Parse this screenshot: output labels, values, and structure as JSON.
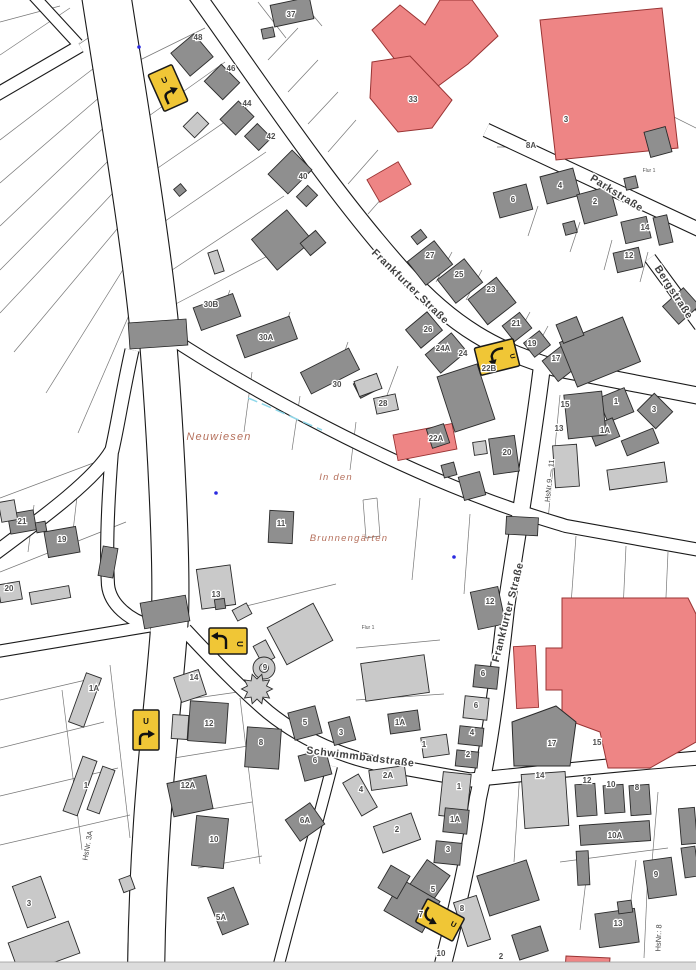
{
  "map": {
    "colors": {
      "background": "#ffffff",
      "building_dark": "#8f8f8f",
      "building_light": "#c9c9c9",
      "building_public": "#ee8585",
      "building_outline": "#2b2b2b",
      "public_outline": "#993333",
      "road_casing": "#1a1a1a",
      "road_fill": "#ffffff",
      "crossing_fill": "#8f8f8f",
      "parcel_line": "#777777",
      "sign_fill": "#f0c636",
      "sign_border": "#1a1a1a",
      "street_text": "#3f3f3f",
      "area_text": "#b5705c",
      "number_text": "#4d4d4d",
      "water": "#8fd8ea",
      "dot": "#2a2ae0",
      "edge_strip": "#dcdcdc"
    },
    "street_labels": [
      {
        "text": "Frankfurter Straße",
        "x": 408,
        "y": 289,
        "rot": 44,
        "size": 10.5
      },
      {
        "text": "Frankfurter Straße",
        "x": 511,
        "y": 613,
        "rot": -76,
        "size": 10.5
      },
      {
        "text": "Parkstraße",
        "x": 615,
        "y": 196,
        "rot": 32,
        "size": 10.5
      },
      {
        "text": "Bergstraße",
        "x": 671,
        "y": 294,
        "rot": 57,
        "size": 10.5
      },
      {
        "text": "Schwimmbadstraße",
        "x": 360,
        "y": 760,
        "rot": 7,
        "size": 10.5
      }
    ],
    "area_labels": [
      {
        "text": "Neuwiesen",
        "x": 219,
        "y": 440,
        "rot": 0,
        "size": 11
      },
      {
        "text": "In den",
        "x": 336,
        "y": 480,
        "rot": 0,
        "size": 9.5
      },
      {
        "text": "Brunnengärten",
        "x": 349,
        "y": 541,
        "rot": 0,
        "size": 9.5
      }
    ],
    "hsnr_labels": [
      {
        "text": "HsNr 9 — 11",
        "x": 552,
        "y": 481,
        "rot": -84,
        "size": 7.5
      },
      {
        "text": "HsNr. 3A",
        "x": 90,
        "y": 846,
        "rot": -80,
        "size": 7.5
      },
      {
        "text": "HsNr.: 8",
        "x": 661,
        "y": 938,
        "rot": -88,
        "size": 7.5
      }
    ],
    "flur_labels": [
      {
        "text": "Flur 1",
        "x": 649,
        "y": 172,
        "size": 5
      },
      {
        "text": "Flur 1",
        "x": 368,
        "y": 629,
        "size": 5
      }
    ],
    "house_numbers": [
      {
        "t": "48",
        "x": 198,
        "y": 40,
        "r": -35
      },
      {
        "t": "37",
        "x": 291,
        "y": 17,
        "r": -12
      },
      {
        "t": "46",
        "x": 231,
        "y": 71,
        "r": -48
      },
      {
        "t": "44",
        "x": 247,
        "y": 106,
        "r": -52
      },
      {
        "t": "42",
        "x": 271,
        "y": 139,
        "r": -52
      },
      {
        "t": "40",
        "x": 303,
        "y": 179,
        "r": -52
      },
      {
        "t": "33",
        "x": 413,
        "y": 102,
        "r": -58
      },
      {
        "t": "3",
        "x": 566,
        "y": 122,
        "r": -72
      },
      {
        "t": "8A",
        "x": 531,
        "y": 148,
        "r": 0
      },
      {
        "t": "6",
        "x": 513,
        "y": 202,
        "r": -14
      },
      {
        "t": "4",
        "x": 560,
        "y": 188,
        "r": -14
      },
      {
        "t": "2",
        "x": 595,
        "y": 204,
        "r": -14
      },
      {
        "t": "14",
        "x": 645,
        "y": 230,
        "r": -84
      },
      {
        "t": "12",
        "x": 629,
        "y": 258,
        "r": -84
      },
      {
        "t": "27",
        "x": 430,
        "y": 258,
        "r": -36
      },
      {
        "t": "25",
        "x": 459,
        "y": 277,
        "r": -36
      },
      {
        "t": "23",
        "x": 491,
        "y": 292,
        "r": -36
      },
      {
        "t": "21",
        "x": 516,
        "y": 326,
        "r": -8
      },
      {
        "t": "19",
        "x": 532,
        "y": 346,
        "r": -8
      },
      {
        "t": "17",
        "x": 556,
        "y": 361,
        "r": -8
      },
      {
        "t": "26",
        "x": 428,
        "y": 332,
        "r": -40
      },
      {
        "t": "24A",
        "x": 443,
        "y": 351,
        "r": -40
      },
      {
        "t": "24",
        "x": 463,
        "y": 356,
        "r": -40
      },
      {
        "t": "22B",
        "x": 489,
        "y": 371,
        "r": -34
      },
      {
        "t": "30B",
        "x": 211,
        "y": 307,
        "r": -20
      },
      {
        "t": "30A",
        "x": 266,
        "y": 340,
        "r": -20
      },
      {
        "t": "30",
        "x": 337,
        "y": 387,
        "r": -26
      },
      {
        "t": "28",
        "x": 383,
        "y": 406,
        "r": -10
      },
      {
        "t": "22A",
        "x": 436,
        "y": 441,
        "r": -10
      },
      {
        "t": "20",
        "x": 507,
        "y": 455,
        "r": -84
      },
      {
        "t": "15",
        "x": 565,
        "y": 407,
        "r": -84
      },
      {
        "t": "13",
        "x": 559,
        "y": 431,
        "r": -84
      },
      {
        "t": "1",
        "x": 616,
        "y": 404,
        "r": -38
      },
      {
        "t": "1A",
        "x": 605,
        "y": 433,
        "r": -22
      },
      {
        "t": "3",
        "x": 654,
        "y": 412,
        "r": -42
      },
      {
        "t": "21",
        "x": 22,
        "y": 524,
        "r": -6
      },
      {
        "t": "19",
        "x": 62,
        "y": 542,
        "r": -6
      },
      {
        "t": "20",
        "x": 9,
        "y": 591,
        "r": -6
      },
      {
        "t": "11",
        "x": 281,
        "y": 526,
        "r": 0
      },
      {
        "t": "13",
        "x": 216,
        "y": 597,
        "r": 0
      },
      {
        "t": "1A",
        "x": 94,
        "y": 691,
        "r": -75
      },
      {
        "t": "1",
        "x": 86,
        "y": 788,
        "r": -75
      },
      {
        "t": "14",
        "x": 194,
        "y": 680,
        "r": -14
      },
      {
        "t": "12",
        "x": 209,
        "y": 726,
        "r": -8
      },
      {
        "t": "9",
        "x": 265,
        "y": 670,
        "r": -30
      },
      {
        "t": "8",
        "x": 261,
        "y": 745,
        "r": -12
      },
      {
        "t": "5",
        "x": 305,
        "y": 725,
        "r": -12
      },
      {
        "t": "3",
        "x": 341,
        "y": 735,
        "r": -12
      },
      {
        "t": "6",
        "x": 315,
        "y": 763,
        "r": -12
      },
      {
        "t": "12A",
        "x": 188,
        "y": 788,
        "r": -10
      },
      {
        "t": "10",
        "x": 214,
        "y": 842,
        "r": -6
      },
      {
        "t": "6A",
        "x": 305,
        "y": 823,
        "r": -12
      },
      {
        "t": "5A",
        "x": 221,
        "y": 920,
        "r": -32
      },
      {
        "t": "3",
        "x": 29,
        "y": 906,
        "r": -78
      },
      {
        "t": "12",
        "x": 490,
        "y": 604,
        "r": -84
      },
      {
        "t": "6",
        "x": 483,
        "y": 676,
        "r": -84
      },
      {
        "t": "6",
        "x": 476,
        "y": 708,
        "r": -84
      },
      {
        "t": "4",
        "x": 472,
        "y": 735,
        "r": -84
      },
      {
        "t": "2",
        "x": 468,
        "y": 757,
        "r": -84
      },
      {
        "t": "1A",
        "x": 400,
        "y": 725,
        "r": 0
      },
      {
        "t": "1",
        "x": 424,
        "y": 747,
        "r": -12
      },
      {
        "t": "1",
        "x": 459,
        "y": 789,
        "r": -78
      },
      {
        "t": "1A",
        "x": 455,
        "y": 822,
        "r": -78
      },
      {
        "t": "3",
        "x": 448,
        "y": 852,
        "r": -78
      },
      {
        "t": "2",
        "x": 397,
        "y": 832,
        "r": -30
      },
      {
        "t": "4",
        "x": 361,
        "y": 792,
        "r": -55
      },
      {
        "t": "2A",
        "x": 388,
        "y": 778,
        "r": 0
      },
      {
        "t": "17",
        "x": 552,
        "y": 746,
        "r": 0
      },
      {
        "t": "15",
        "x": 597,
        "y": 745,
        "r": 0
      },
      {
        "t": "14",
        "x": 540,
        "y": 778,
        "r": -8
      },
      {
        "t": "12",
        "x": 587,
        "y": 783,
        "r": 0
      },
      {
        "t": "10",
        "x": 611,
        "y": 787,
        "r": 0
      },
      {
        "t": "8",
        "x": 637,
        "y": 790,
        "r": -8
      },
      {
        "t": "10A",
        "x": 615,
        "y": 838,
        "r": 0
      },
      {
        "t": "9",
        "x": 656,
        "y": 877,
        "r": -78
      },
      {
        "t": "13",
        "x": 618,
        "y": 926,
        "r": -78
      },
      {
        "t": "5",
        "x": 433,
        "y": 892,
        "r": -55
      },
      {
        "t": "7",
        "x": 421,
        "y": 917,
        "r": -55
      },
      {
        "t": "8",
        "x": 462,
        "y": 911,
        "r": -78
      },
      {
        "t": "10",
        "x": 441,
        "y": 956,
        "r": -65
      },
      {
        "t": "2",
        "x": 501,
        "y": 959,
        "r": -42
      }
    ],
    "signs": [
      {
        "variant": "u-turn-right",
        "x": 168,
        "y": 88,
        "rot": -24,
        "label": "U"
      },
      {
        "variant": "turn-right-u",
        "x": 497,
        "y": 357,
        "rot": -14,
        "label": "U"
      },
      {
        "variant": "turn-left-u",
        "x": 228,
        "y": 641,
        "rot": 0,
        "label": "U"
      },
      {
        "variant": "u-turn-right",
        "x": 146,
        "y": 730,
        "rot": 0,
        "label": "U"
      },
      {
        "variant": "turn-left-u-vert",
        "x": 440,
        "y": 920,
        "rot": -62,
        "label": "U"
      }
    ],
    "water_dots": [
      {
        "x": 139,
        "y": 47
      },
      {
        "x": 216,
        "y": 493
      },
      {
        "x": 454,
        "y": 557
      }
    ]
  }
}
